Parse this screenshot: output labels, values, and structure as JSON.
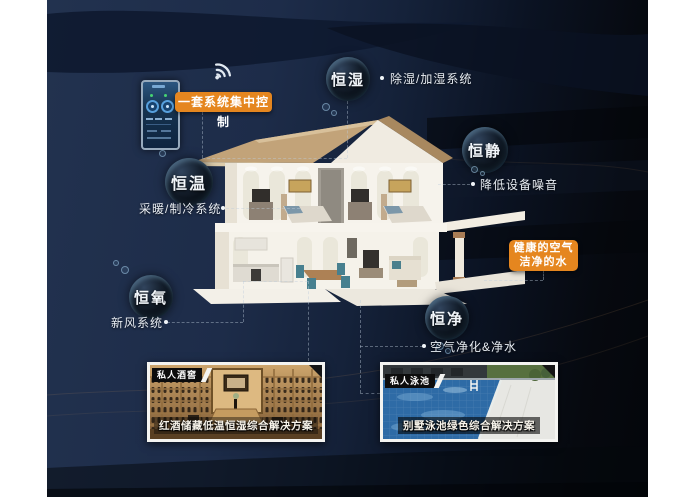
{
  "control": {
    "label": "一套系统集中控制",
    "phone_icon": "smart-control-panel",
    "wifi_icon": "wifi"
  },
  "features": [
    {
      "bubble": "恒湿",
      "note": "除湿/加湿系统"
    },
    {
      "bubble": "恒静",
      "note": "降低设备噪音"
    },
    {
      "bubble": "恒温",
      "note": "采暖/制冷系统"
    },
    {
      "bubble": "恒氧",
      "note": "新风系统"
    },
    {
      "bubble": "恒净",
      "note": "空气净化&净水"
    }
  ],
  "highlight": {
    "line1": "健康的空气",
    "line2": "洁净的水"
  },
  "cards": [
    {
      "tag": "私人酒窖",
      "caption": "红酒储藏低温恒湿综合解决方案"
    },
    {
      "tag": "私人泳池",
      "caption": "别墅泳池绿色综合解决方案"
    }
  ],
  "colors": {
    "accent_orange": "#e5861f",
    "background_navy": "#1d2c49",
    "background_dark": "#06090f",
    "bubble_text": "#f2f6fa"
  }
}
